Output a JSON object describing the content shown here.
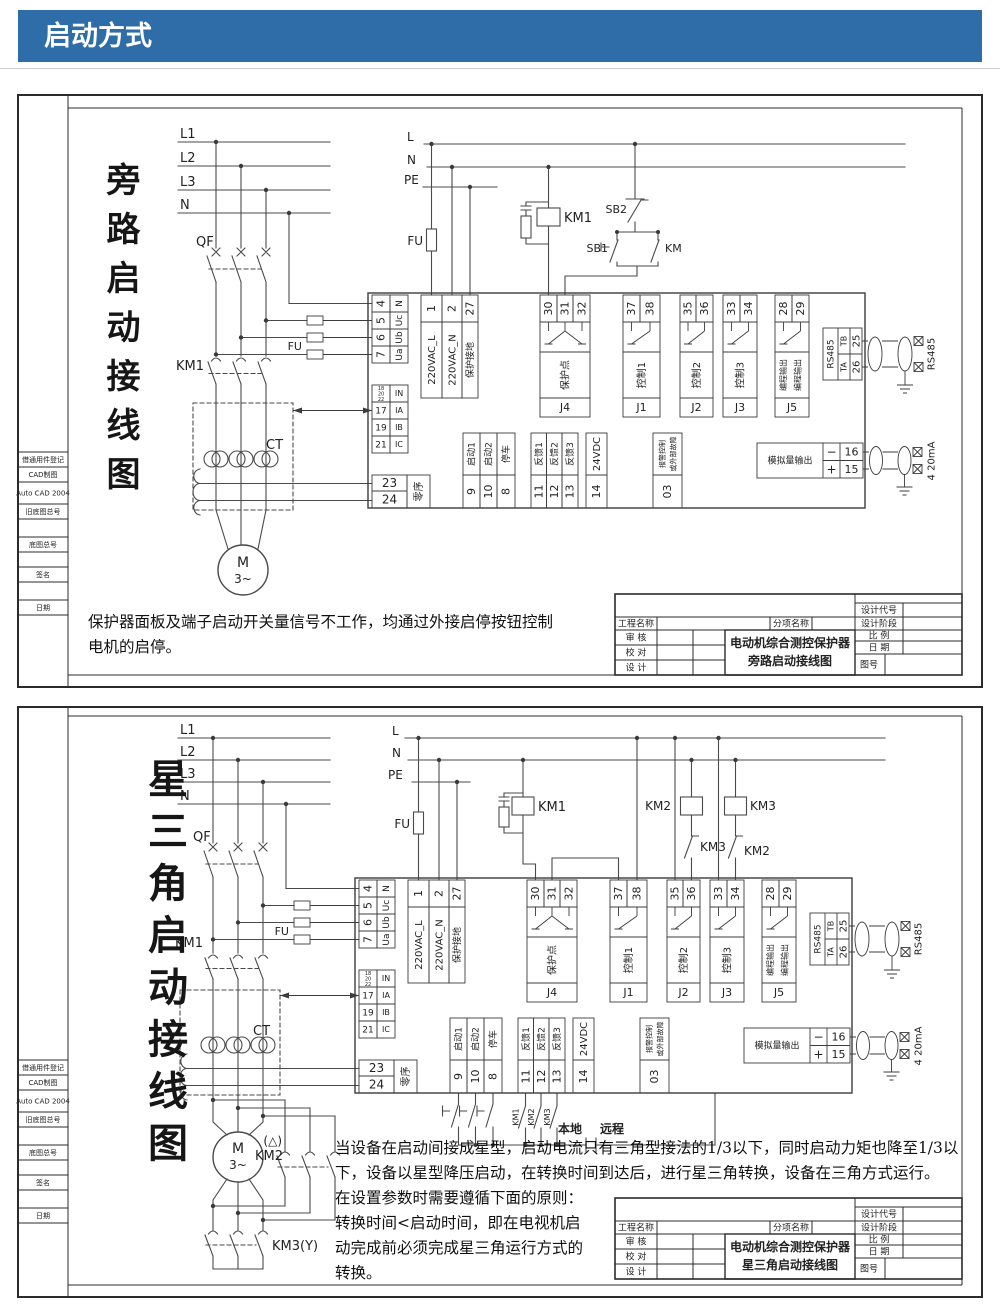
{
  "header": {
    "title": "启动方式"
  },
  "sidebar": {
    "r1": "借通用件登记",
    "r2": "CAD制图",
    "r3": "Auto CAD 2004",
    "r4": "旧底图总号",
    "r5": "底图总号",
    "r6": "签名",
    "r7": "日期"
  },
  "titleblock": {
    "project": "工程名称",
    "subitem": "分项名称",
    "code": "设计代号",
    "stage": "设计阶段",
    "review": "审  核",
    "proof": "校  对",
    "design": "设  计",
    "scale": "比  例",
    "date": "日  期",
    "fig": "图号"
  },
  "device": {
    "volt_terms": [
      {
        "n": "4",
        "l": "N"
      },
      {
        "n": "5",
        "l": "Uc"
      },
      {
        "n": "6",
        "l": "Ub"
      },
      {
        "n": "7",
        "l": "Ua"
      }
    ],
    "cur_head": {
      "n1": "18",
      "n2": "20",
      "n3": "22",
      "l": "IN"
    },
    "cur_terms": [
      {
        "n": "17",
        "l": "IA"
      },
      {
        "n": "19",
        "l": "IB"
      },
      {
        "n": "21",
        "l": "IC"
      }
    ],
    "zero": {
      "t1": "23",
      "t2": "24",
      "label": "零序"
    },
    "power": [
      {
        "n": "1",
        "l": "220VAC_L"
      },
      {
        "n": "2",
        "l": "220VAC_N"
      },
      {
        "n": "27",
        "l": "保护接地"
      }
    ],
    "j4": {
      "name": "J4",
      "label": "保护点",
      "t1": "30",
      "t2": "31",
      "t3": "32"
    },
    "j1": {
      "name": "J1",
      "label": "控制1",
      "t1": "37",
      "t2": "38"
    },
    "j2": {
      "name": "J2",
      "label": "控制2",
      "t1": "35",
      "t2": "36"
    },
    "j3": {
      "name": "J3",
      "label": "控制3",
      "t1": "33",
      "t2": "34"
    },
    "j5": {
      "name": "J5",
      "label1": "编程输出",
      "label2": "编程输出",
      "t1": "28",
      "t2": "29"
    },
    "rs485": {
      "name": "RS485",
      "tb": "TB",
      "ta": "TA",
      "t25": "25",
      "t26": "26",
      "ext": "RS485"
    },
    "analog": {
      "label": "模拟量输出",
      "minus": "−",
      "plus": "+",
      "t16": "16",
      "t15": "15",
      "ext": "4 20mA"
    },
    "din": [
      {
        "n": "9",
        "l": "启动1"
      },
      {
        "n": "10",
        "l": "启动2"
      },
      {
        "n": "8",
        "l": "停车"
      },
      {
        "n": "11",
        "l": "反馈1"
      },
      {
        "n": "12",
        "l": "反馈2"
      },
      {
        "n": "13",
        "l": "反馈3"
      },
      {
        "n": "14",
        "l": "24VDC"
      }
    ],
    "alarm": {
      "n": "03",
      "l1": "报警控制",
      "l2": "或外部故障"
    },
    "fu": "FU"
  },
  "diagram1": {
    "title_v": "旁路启动接线图",
    "l1": "L1",
    "l2": "L2",
    "l3": "L3",
    "n": "N",
    "qf": "QF",
    "km1": "KM1",
    "ct": "CT",
    "l": "L",
    "n2": "N",
    "pe": "PE",
    "fu": "FU",
    "km1_coil": "KM1",
    "sb2": "SB2",
    "sb1": "SB1",
    "km": "KM",
    "motor": "M",
    "motor_ph": "3~",
    "note1": "保护器面板及端子启动开关量信号不工作，均通过外接启停按钮控制",
    "note2": "电机的启停。",
    "tb1": "电动机综合测控保护器",
    "tb2": "旁路启动接线图"
  },
  "diagram2": {
    "title_v": "星三角启动接线图",
    "l1": "L1",
    "l2": "L2",
    "l3": "L3",
    "n": "N",
    "qf": "QF",
    "km1": "KM1",
    "ct": "CT",
    "l": "L",
    "n2": "N",
    "pe": "PE",
    "fu": "FU",
    "km1_coil": "KM1",
    "km2_coil": "KM2",
    "km3_coil": "KM3",
    "km3_nc": "KM3",
    "km2_nc": "KM2",
    "delta": "(△)",
    "km2_main": "KM2",
    "km3_main": "KM3(Y)",
    "motor": "M",
    "motor_ph": "3~",
    "aux1": "KM1",
    "aux2": "KM2",
    "aux3": "KM3",
    "local": "本地",
    "remote": "远程",
    "note1": "当设备在启动间接成星型，启动电流只有三角型接法的1/3以下，同时启动力矩也降至1/3以",
    "note2": "下，设备以星型降压启动，在转换时间到达后，进行星三角转换，设备在三角方式运行。",
    "note3": "在设置参数时需要遵循下面的原则：",
    "note4": "转换时间<启动时间，即在电视机启",
    "note5": "动完成前必须完成星三角运行方式的",
    "note6": "转换。",
    "tb1": "电动机综合测控保护器",
    "tb2": "星三角启动接线图"
  }
}
